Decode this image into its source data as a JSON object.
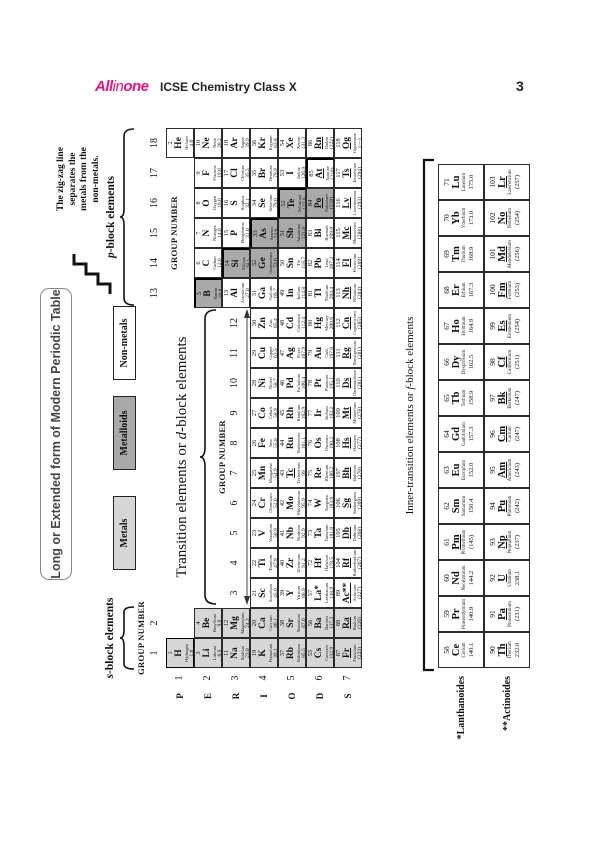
{
  "header": {
    "logo_all": "All",
    "logo_in": "in",
    "logo_one": "one",
    "book_title": "ICSE Chemistry Class X",
    "page_number": "3"
  },
  "figure": {
    "title": "Long or Extended form of Modern Periodic Table",
    "legend": [
      {
        "label": "Metals",
        "type": "metal"
      },
      {
        "label": "Metalloids",
        "type": "metalloid"
      },
      {
        "label": "Non-metals",
        "type": "nonmetal"
      }
    ],
    "note_lines": [
      "The zig-zag line",
      "separates the",
      "metals from the",
      "non-metals."
    ],
    "labels": {
      "group_number": "GROUP NUMBER",
      "periods": "PERIODS",
      "s_it": "s",
      "s_post": "-block elements",
      "p_it": "p",
      "p_post": "-block elements",
      "d_pre": "Transition elements or ",
      "d_it": "d",
      "d_post": "-block elements",
      "f_pre": "Inner-transition elements or ",
      "f_it": "f",
      "f_post": "-block elements",
      "lanthanoides": "*Lanthanoides",
      "actinoides": "**Actinoides"
    },
    "group_numbers": [
      "1",
      "2",
      "3",
      "4",
      "5",
      "6",
      "7",
      "8",
      "9",
      "10",
      "11",
      "12",
      "13",
      "14",
      "15",
      "16",
      "17",
      "18"
    ],
    "period_numbers": [
      "1",
      "2",
      "3",
      "4",
      "5",
      "6",
      "7"
    ],
    "colors": {
      "metal": "#d6d6d6",
      "metalloid": "#a9a9a9",
      "nonmetal": "#ffffff",
      "accent": "#e5127d"
    },
    "elements": [
      [
        1,
        "H",
        "Hydrogen",
        "1.0",
        1,
        1,
        "m",
        0,
        ""
      ],
      [
        2,
        "He",
        "Helium",
        "4.0",
        18,
        1,
        "",
        0,
        ""
      ],
      [
        3,
        "Li",
        "Lithium",
        "6.9",
        1,
        2,
        "m",
        0,
        ""
      ],
      [
        4,
        "Be",
        "Beryllium",
        "9.0",
        2,
        2,
        "m",
        0,
        ""
      ],
      [
        5,
        "B",
        "Boron",
        "10.8",
        13,
        2,
        "md",
        0,
        "tr"
      ],
      [
        6,
        "C",
        "Carbon",
        "12.0",
        14,
        2,
        "",
        0,
        ""
      ],
      [
        7,
        "N",
        "Nitrogen",
        "14.0",
        15,
        2,
        "",
        0,
        ""
      ],
      [
        8,
        "O",
        "Oxygen",
        "16.0",
        16,
        2,
        "",
        0,
        ""
      ],
      [
        9,
        "F",
        "Fluorine",
        "19.0",
        17,
        2,
        "",
        0,
        ""
      ],
      [
        10,
        "Ne",
        "Neon",
        "20.2",
        18,
        2,
        "",
        0,
        ""
      ],
      [
        11,
        "Na",
        "Sodium",
        "23.0",
        1,
        3,
        "m",
        0,
        ""
      ],
      [
        12,
        "Mg",
        "Magnesium",
        "24.3",
        2,
        3,
        "m",
        0,
        ""
      ],
      [
        13,
        "Al",
        "Aluminium",
        "27.0",
        13,
        3,
        "",
        0,
        ""
      ],
      [
        14,
        "Si",
        "Silicon",
        "28.1",
        14,
        3,
        "md",
        0,
        "tr"
      ],
      [
        15,
        "P",
        "Phosphorus",
        "31.0",
        15,
        3,
        "",
        0,
        ""
      ],
      [
        16,
        "S",
        "Sulphur",
        "32.1",
        16,
        3,
        "",
        0,
        ""
      ],
      [
        17,
        "Cl",
        "Chlorine",
        "35.5",
        17,
        3,
        "",
        0,
        ""
      ],
      [
        18,
        "Ar",
        "Argon",
        "39.9",
        18,
        3,
        "",
        0,
        ""
      ],
      [
        19,
        "K",
        "Potassium",
        "39.1",
        1,
        4,
        "m",
        0,
        ""
      ],
      [
        20,
        "Ca",
        "Calcium",
        "40.1",
        2,
        4,
        "m",
        0,
        ""
      ],
      [
        21,
        "Sc",
        "Scandium",
        "45.0",
        3,
        4,
        "",
        0,
        ""
      ],
      [
        22,
        "Ti",
        "Titanium",
        "47.9",
        4,
        4,
        "",
        0,
        ""
      ],
      [
        23,
        "V",
        "Vanadium",
        "50.9",
        5,
        4,
        "",
        0,
        ""
      ],
      [
        24,
        "Cr",
        "Chromium",
        "52.0",
        6,
        4,
        "",
        0,
        ""
      ],
      [
        25,
        "Mn",
        "Manganese",
        "54.9",
        7,
        4,
        "",
        0,
        ""
      ],
      [
        26,
        "Fe",
        "Iron",
        "55.8",
        8,
        4,
        "",
        0,
        ""
      ],
      [
        27,
        "Co",
        "Cobalt",
        "58.9",
        9,
        4,
        "",
        0,
        ""
      ],
      [
        28,
        "Ni",
        "Nickel",
        "58.7",
        10,
        4,
        "",
        0,
        ""
      ],
      [
        29,
        "Cu",
        "Copper",
        "63.5",
        11,
        4,
        "",
        0,
        ""
      ],
      [
        30,
        "Zn",
        "Zinc",
        "65.4",
        12,
        4,
        "",
        0,
        ""
      ],
      [
        31,
        "Ga",
        "Gallium",
        "69.7",
        13,
        4,
        "",
        0,
        ""
      ],
      [
        32,
        "Ge",
        "Germanium",
        "72.6",
        14,
        4,
        "md",
        0,
        ""
      ],
      [
        33,
        "As",
        "Arsenic",
        "74.9",
        15,
        4,
        "md",
        0,
        "tr"
      ],
      [
        34,
        "Se",
        "Selenium",
        "79.0",
        16,
        4,
        "",
        0,
        ""
      ],
      [
        35,
        "Br",
        "Bromine",
        "79.9",
        17,
        4,
        "",
        0,
        ""
      ],
      [
        36,
        "Kr",
        "Krypton",
        "83.8",
        18,
        4,
        "",
        0,
        ""
      ],
      [
        37,
        "Rb",
        "Rubidium",
        "85.5",
        1,
        5,
        "m",
        0,
        ""
      ],
      [
        38,
        "Sr",
        "Strontium",
        "87.6",
        2,
        5,
        "m",
        0,
        ""
      ],
      [
        39,
        "Y",
        "Yttrium",
        "88.9",
        3,
        5,
        "",
        0,
        ""
      ],
      [
        40,
        "Zr",
        "Zirconium",
        "91.2",
        4,
        5,
        "",
        0,
        ""
      ],
      [
        41,
        "Nb",
        "Niobium",
        "92.9",
        5,
        5,
        "",
        0,
        ""
      ],
      [
        42,
        "Mo",
        "Molybdenum",
        "95.9",
        6,
        5,
        "",
        0,
        ""
      ],
      [
        43,
        "Tc",
        "Technetium",
        "99",
        7,
        5,
        "",
        1,
        ""
      ],
      [
        44,
        "Ru",
        "Ruthenium",
        "101.1",
        8,
        5,
        "",
        0,
        ""
      ],
      [
        45,
        "Rh",
        "Rhodium",
        "102.9",
        9,
        5,
        "",
        0,
        ""
      ],
      [
        46,
        "Pd",
        "Palladium",
        "106.4",
        10,
        5,
        "",
        0,
        ""
      ],
      [
        47,
        "Ag",
        "Silver",
        "107.9",
        11,
        5,
        "",
        0,
        ""
      ],
      [
        48,
        "Cd",
        "Cadmium",
        "112.4",
        12,
        5,
        "",
        0,
        ""
      ],
      [
        49,
        "In",
        "Indium",
        "114.8",
        13,
        5,
        "",
        0,
        ""
      ],
      [
        50,
        "Sn",
        "Tin",
        "118.7",
        14,
        5,
        "",
        0,
        ""
      ],
      [
        51,
        "Sb",
        "Antimony",
        "121.8",
        15,
        5,
        "md",
        0,
        ""
      ],
      [
        52,
        "Te",
        "Tellurium",
        "127.6",
        16,
        5,
        "md",
        0,
        "tr"
      ],
      [
        53,
        "I",
        "Iodine",
        "126.9",
        17,
        5,
        "",
        0,
        ""
      ],
      [
        54,
        "Xe",
        "Xenon",
        "131.3",
        18,
        5,
        "",
        0,
        ""
      ],
      [
        55,
        "Cs",
        "Caesium",
        "132.9",
        1,
        6,
        "m",
        0,
        ""
      ],
      [
        56,
        "Ba",
        "Barium",
        "137.3",
        2,
        6,
        "m",
        0,
        ""
      ],
      [
        57,
        "La*",
        "Lanthanum",
        "138.9",
        3,
        6,
        "",
        0,
        ""
      ],
      [
        72,
        "Hf",
        "Hafnium",
        "178.5",
        4,
        6,
        "",
        0,
        ""
      ],
      [
        73,
        "Ta",
        "Tantalum",
        "181.0",
        5,
        6,
        "",
        0,
        ""
      ],
      [
        74,
        "W",
        "Tungsten",
        "183.9",
        6,
        6,
        "",
        0,
        ""
      ],
      [
        75,
        "Re",
        "Rhenium",
        "186.2",
        7,
        6,
        "",
        0,
        ""
      ],
      [
        76,
        "Os",
        "Osmium",
        "190.2",
        8,
        6,
        "",
        0,
        ""
      ],
      [
        77,
        "Ir",
        "Iridium",
        "192.2",
        9,
        6,
        "",
        0,
        ""
      ],
      [
        78,
        "Pt",
        "Platinum",
        "195.1",
        10,
        6,
        "",
        0,
        ""
      ],
      [
        79,
        "Au",
        "Gold",
        "197.0",
        11,
        6,
        "",
        0,
        ""
      ],
      [
        80,
        "Hg",
        "Mercury",
        "200.6",
        12,
        6,
        "",
        0,
        ""
      ],
      [
        81,
        "Tl",
        "Thallium",
        "204.4",
        13,
        6,
        "",
        0,
        ""
      ],
      [
        82,
        "Pb",
        "Lead",
        "207.2",
        14,
        6,
        "",
        0,
        ""
      ],
      [
        83,
        "Bi",
        "Bismuth",
        "209.0",
        15,
        6,
        "",
        0,
        ""
      ],
      [
        84,
        "Po",
        "Polonium",
        "(210)",
        16,
        6,
        "md",
        1,
        ""
      ],
      [
        85,
        "At",
        "Astatine",
        "(210)",
        17,
        6,
        "",
        1,
        "tr"
      ],
      [
        86,
        "Rn",
        "Radon",
        "(222)",
        18,
        6,
        "",
        1,
        ""
      ],
      [
        87,
        "Fr",
        "Francium",
        "(223)",
        1,
        7,
        "m",
        1,
        ""
      ],
      [
        88,
        "Ra",
        "Radium",
        "(226)",
        2,
        7,
        "m",
        1,
        ""
      ],
      [
        89,
        "Ac**",
        "Actinium",
        "(227)",
        3,
        7,
        "",
        1,
        ""
      ],
      [
        104,
        "Rf",
        "Rutherfordium",
        "(267)",
        4,
        7,
        "",
        1,
        ""
      ],
      [
        105,
        "Db",
        "Dubnium",
        "(268)",
        5,
        7,
        "",
        1,
        ""
      ],
      [
        106,
        "Sg",
        "Seaborgium",
        "(269)",
        6,
        7,
        "",
        1,
        ""
      ],
      [
        107,
        "Bh",
        "Bohrium",
        "(270)",
        7,
        7,
        "",
        1,
        ""
      ],
      [
        108,
        "Hs",
        "Hassium",
        "(277)",
        8,
        7,
        "",
        1,
        ""
      ],
      [
        109,
        "Mt",
        "Meitnerium",
        "(278)",
        9,
        7,
        "",
        1,
        ""
      ],
      [
        110,
        "Ds",
        "Darmstadtium",
        "(281)",
        10,
        7,
        "",
        1,
        ""
      ],
      [
        111,
        "Rg",
        "Roentgenium",
        "(281)",
        11,
        7,
        "",
        1,
        ""
      ],
      [
        112,
        "Cn",
        "Copernicium",
        "(285)",
        12,
        7,
        "",
        1,
        ""
      ],
      [
        113,
        "Nh",
        "Nihonium",
        "(284)",
        13,
        7,
        "",
        1,
        ""
      ],
      [
        114,
        "Fl",
        "Flerovium",
        "(289)",
        14,
        7,
        "",
        1,
        ""
      ],
      [
        115,
        "Mc",
        "Moscovium",
        "(288)",
        15,
        7,
        "",
        1,
        ""
      ],
      [
        116,
        "Lv",
        "Livermorium",
        "(293)",
        16,
        7,
        "",
        1,
        ""
      ],
      [
        117,
        "Ts",
        "Tennessine",
        "(294)",
        17,
        7,
        "",
        1,
        ""
      ],
      [
        118,
        "Og",
        "Oganesson",
        "(—)",
        18,
        7,
        "",
        1,
        ""
      ]
    ],
    "lanthanoides": [
      [
        58,
        "Ce",
        "Cerium",
        "140.1",
        0
      ],
      [
        59,
        "Pr",
        "Praseodymium",
        "140.9",
        0
      ],
      [
        60,
        "Nd",
        "Neodymium",
        "144.2",
        0
      ],
      [
        61,
        "Pm",
        "Promethium",
        "(145)",
        1
      ],
      [
        62,
        "Sm",
        "Samarium",
        "150.4",
        0
      ],
      [
        63,
        "Eu",
        "Europium",
        "152.0",
        0
      ],
      [
        64,
        "Gd",
        "Gadolinium",
        "157.3",
        0
      ],
      [
        65,
        "Tb",
        "Terbium",
        "158.9",
        0
      ],
      [
        66,
        "Dy",
        "Dysprosium",
        "162.5",
        0
      ],
      [
        67,
        "Ho",
        "Holmium",
        "164.9",
        0
      ],
      [
        68,
        "Er",
        "Erbium",
        "167.3",
        0
      ],
      [
        69,
        "Tm",
        "Thulium",
        "168.9",
        0
      ],
      [
        70,
        "Yb",
        "Ytterbium",
        "173.0",
        0
      ],
      [
        71,
        "Lu",
        "Lutetium",
        "175.0",
        0
      ]
    ],
    "actinoides": [
      [
        90,
        "Th",
        "Thorium",
        "232.0",
        1
      ],
      [
        91,
        "Pa",
        "Protactinium",
        "(231)",
        1
      ],
      [
        92,
        "U",
        "Uranium",
        "238.1",
        1
      ],
      [
        93,
        "Np",
        "Neptunium",
        "(237)",
        1
      ],
      [
        94,
        "Pu",
        "Plutonium",
        "(242)",
        1
      ],
      [
        95,
        "Am",
        "Americium",
        "(243)",
        1
      ],
      [
        96,
        "Cm",
        "Curium",
        "(247)",
        1
      ],
      [
        97,
        "Bk",
        "Berkelium",
        "(247)",
        1
      ],
      [
        98,
        "Cf",
        "Californium",
        "(251)",
        1
      ],
      [
        99,
        "Es",
        "Einsteinium",
        "(254)",
        1
      ],
      [
        100,
        "Fm",
        "Fermium",
        "(253)",
        1
      ],
      [
        101,
        "Md",
        "Mendelevium",
        "(256)",
        1
      ],
      [
        102,
        "No",
        "Nobelium",
        "(254)",
        1
      ],
      [
        103,
        "Lr",
        "Lawrencium",
        "(257)",
        1
      ]
    ]
  }
}
